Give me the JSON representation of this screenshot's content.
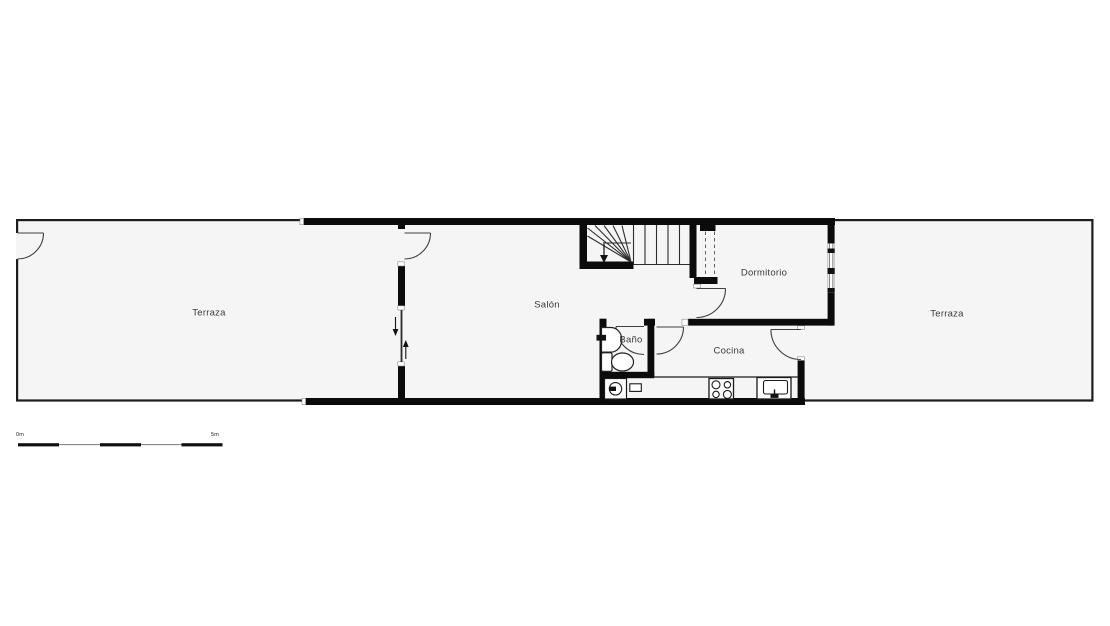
{
  "plan": {
    "rooms": [
      {
        "name": "terraza-left",
        "label": "Terraza",
        "x": 209,
        "y": 313
      },
      {
        "name": "salon",
        "label": "Salón",
        "x": 547,
        "y": 305
      },
      {
        "name": "dormitorio",
        "label": "Dormitorio",
        "x": 764,
        "y": 273
      },
      {
        "name": "bano",
        "label": "Baño",
        "x": 631,
        "y": 340
      },
      {
        "name": "cocina",
        "label": "Cocina",
        "x": 729,
        "y": 351
      },
      {
        "name": "terraza-right",
        "label": "Terraza",
        "x": 947,
        "y": 314
      }
    ],
    "scale_bar": {
      "start_label": "0m",
      "end_label": "5m",
      "segments": 5
    },
    "colors": {
      "wall": "#0b0b0b",
      "thin_wall": "#1c1c1c",
      "floor": "#f5f5f5",
      "line": "#3f3f3f",
      "background": "#ffffff"
    },
    "fixtures": [
      "staircase",
      "stair-direction-arrow",
      "bathroom-sink",
      "toilet",
      "washing-machine",
      "kitchen-counter",
      "kitchen-hob",
      "kitchen-sink",
      "wardrobe-dashed",
      "window"
    ],
    "doors": [
      "terraza-left-door",
      "salon-door",
      "salon-sliding-door",
      "dormitorio-door",
      "bano-door",
      "cocina-door",
      "cocina-terraza-door"
    ]
  }
}
